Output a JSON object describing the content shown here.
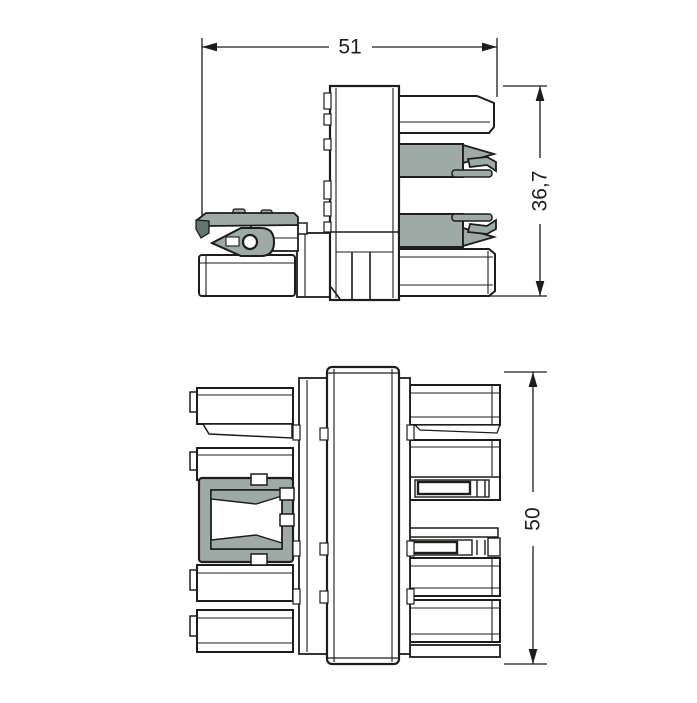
{
  "colors": {
    "background": "#ffffff",
    "line": "#1d1d1b",
    "part_fill": "#9daaa5",
    "part_dark": "#66756f"
  },
  "dimensions": {
    "side_width": "51",
    "side_height": "36,7",
    "top_height": "50"
  }
}
